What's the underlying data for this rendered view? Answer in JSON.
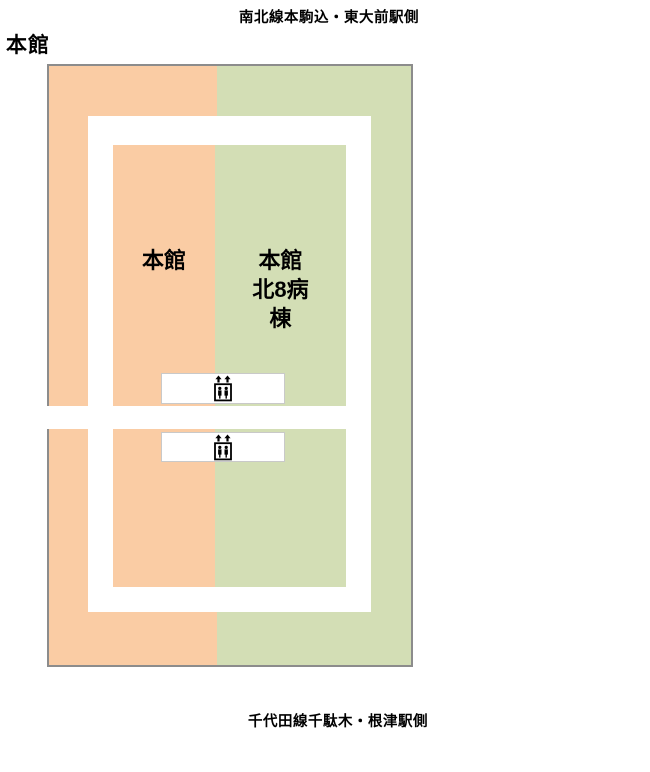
{
  "title": "本館",
  "captions": {
    "north": "南北線本駒込・東大前駅側",
    "south": "千代田線千駄木・根津駅側"
  },
  "areas": [
    {
      "id": "honkan",
      "label": "本館",
      "color": "#FACCA4"
    },
    {
      "id": "honkan-kita8",
      "label": "本館北8病棟",
      "lines": [
        "本館",
        "北8病",
        "棟"
      ],
      "color": "#D3DEB5"
    }
  ],
  "elevators": [
    {
      "icon": "elevator-icon",
      "location": "upper-core"
    },
    {
      "icon": "elevator-icon",
      "location": "lower-core"
    }
  ],
  "colors": {
    "area-honkan": "#FACCA4",
    "area-kita8": "#D3DEB5",
    "building-border": "#8C8C8C",
    "corridor": "#FFFFFF",
    "elevator-box-border": "#C9C9C9"
  }
}
